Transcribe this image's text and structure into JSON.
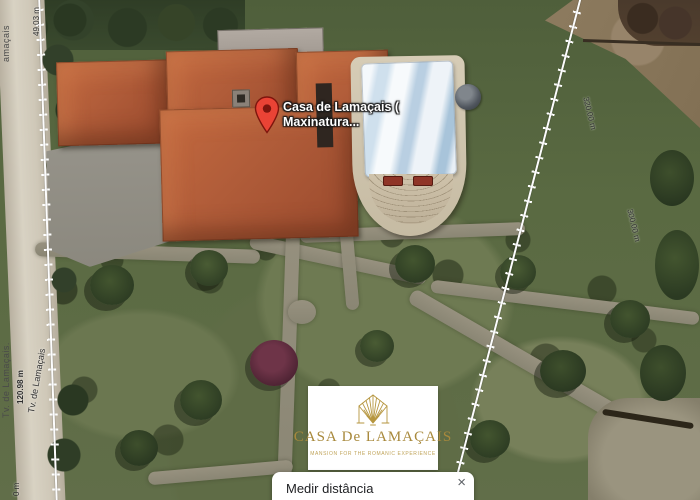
{
  "map": {
    "pin": {
      "label_line1": "Casa de Lamaçais (",
      "label_line2": "Maxinatura..."
    },
    "streets": {
      "strip_top": "amaçais",
      "strip_bottom": "Tv. de Lamaçais.",
      "road_label": "Tv. de Lamaçais"
    },
    "measurements": {
      "top_left": "49.03 m",
      "left": "120.98 m",
      "bottom_left": "0 m",
      "right_upper": "320.00 m",
      "right_lower": "300.00 m"
    }
  },
  "logo_card": {
    "title": "CASA De LAMAÇAIS",
    "subtitle": "MANSION FOR THE ROMANIC EXPERIENCE"
  },
  "popup": {
    "title": "Medir distância",
    "hint": "Clique no mapa e adicione ao seu percurso",
    "close_icon": "×"
  },
  "colors": {
    "pin_red": "#ea4335",
    "roof_terracotta": "#b05c39",
    "logo_gold": "#b6963f",
    "pool_canopy_blue": "#cfe0ed",
    "path_gray": "#97917f"
  }
}
